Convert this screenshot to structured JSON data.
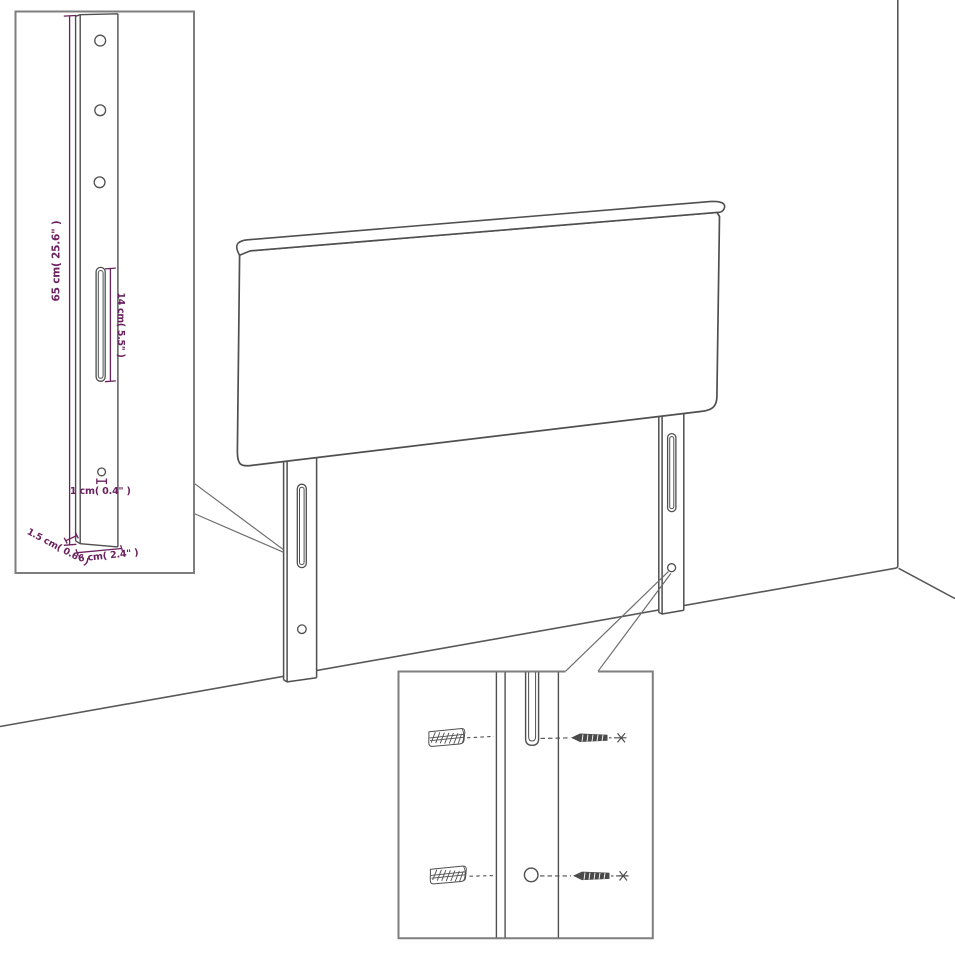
{
  "colors": {
    "line_art": "#4f4f4f",
    "inset_border": "#7e7e7e",
    "callout_line": "#6e6e6e",
    "room_line": "#585858",
    "dimension_text": "#6b2160",
    "background": "#ffffff"
  },
  "leg_inset": {
    "height_label": "65 cm( 25.6\" )",
    "slot_length_label": "14 cm( 5.5\" )",
    "hole_diameter_label": "1 cm( 0.4\" )",
    "thickness_label": "1.5 cm( 0.6\" )",
    "width_label": "6 cm( 2.4\" )"
  },
  "hardware_inset": {
    "icons": [
      "wall-plug-icon",
      "screw-icon",
      "leg-slot-icon",
      "leg-hole-icon"
    ]
  }
}
